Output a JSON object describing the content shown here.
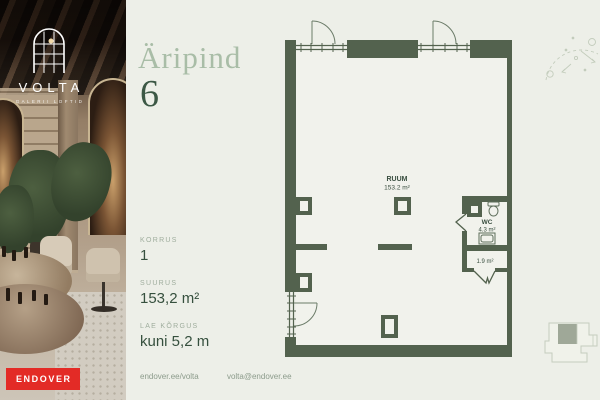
{
  "colors": {
    "background": "#edefe8",
    "wall_green": "#53624e",
    "title_light": "#a9bda7",
    "title_dark": "#3c5845",
    "label_muted": "#9fad9d",
    "value_dark": "#36503e",
    "endover_red": "#e32b26"
  },
  "brand": {
    "logo_name": "VOLTA",
    "logo_subtitle": "GALERII LOFTID",
    "endover_label": "ENDOVER"
  },
  "listing": {
    "type_label": "Äripind",
    "unit_number": "6",
    "details": [
      {
        "label": "KORRUS",
        "value": "1"
      },
      {
        "label": "SUURUS",
        "value": "153,2 m²"
      },
      {
        "label": "LAE KÕRGUS",
        "value": "kuni 5,2 m"
      }
    ],
    "contact": {
      "website": "endover.ee/volta",
      "email": "volta@endover.ee"
    }
  },
  "floorplan": {
    "main_room": {
      "name": "RUUM",
      "area": "153.2 m²"
    },
    "wc": {
      "name": "WC",
      "area": "4.3 m²"
    },
    "vestibule": {
      "area": "1.9 m²"
    }
  }
}
